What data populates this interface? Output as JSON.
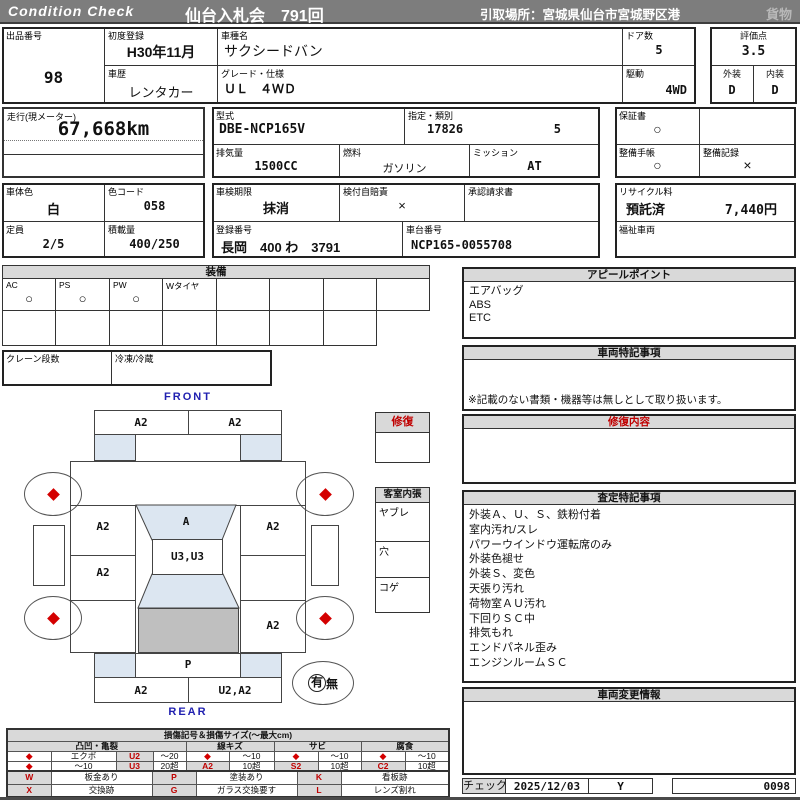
{
  "header": {
    "brand": "Condition  Check",
    "auction_title": "仙台入札会　791回",
    "pickup_location": "引取場所：宮城県仙台市宮城野区港",
    "category": "貨物"
  },
  "info": {
    "lot_label": "出品番号",
    "lot_no": "98",
    "first_reg_label": "初度登録",
    "first_reg": "H30年11月",
    "model_name_label": "車種名",
    "model_name": "サクシードバン",
    "history_label": "車歴",
    "history": "レンタカー",
    "grade_label": "グレード・仕様",
    "grade": "ＵＬ　４ＷＤ",
    "doors_label": "ドア数",
    "doors": "5",
    "drive_label": "駆動",
    "drive": "4WD",
    "score_label": "評価点",
    "score": "3.5",
    "exterior_label": "外装",
    "exterior_grade": "D",
    "interior_label": "内装",
    "interior_grade": "D"
  },
  "meter": {
    "label": "走行(現メーター)",
    "value": "67,668km"
  },
  "spec": {
    "model_code_label": "型式",
    "model_code": "DBE-NCP165V",
    "class_label": "指定・類別",
    "class_no": "17826",
    "class_sub": "5",
    "warranty_label": "保証書",
    "warranty": "○",
    "displacement_label": "排気量",
    "displacement": "1500CC",
    "fuel_label": "燃料",
    "fuel": "ガソリン",
    "mission_label": "ミッション",
    "mission": "AT",
    "maintenance_book_label": "整備手帳",
    "maintenance_book": "○",
    "maintenance_record_label": "整備記録",
    "maintenance_record": "×"
  },
  "registration": {
    "body_color_label": "車体色",
    "body_color": "白",
    "color_code_label": "色コード",
    "color_code": "058",
    "inspection_label": "車検期限",
    "inspection": "抹消",
    "insurance_label": "検付自賠責",
    "insurance": "×",
    "approval_label": "承認請求書",
    "recycle_label": "リサイクル料",
    "recycle_status": "預託済",
    "recycle_fee": "7,440円",
    "capacity_label": "定員",
    "capacity": "2/5",
    "load_label": "積載量",
    "load": "400/250",
    "reg_no_label": "登録番号",
    "reg_no": "長岡　400 わ　3791",
    "chassis_label": "車台番号",
    "chassis_no": "NCP165-0055708",
    "welfare_label": "福祉車両"
  },
  "equipment": {
    "title": "装備",
    "labels": [
      "AC",
      "PS",
      "PW",
      "Wタイヤ",
      "",
      "",
      "",
      ""
    ],
    "values": [
      "○",
      "○",
      "○",
      "",
      "",
      "",
      "",
      ""
    ],
    "crane_label": "クレーン段数",
    "fridge_label": "冷凍/冷蔵"
  },
  "diagram": {
    "front_label": "FRONT",
    "rear_label": "REAR",
    "front_bumper_left": "A2",
    "front_bumper_right": "A2",
    "windshield": "A",
    "left_front_panel": "A2",
    "left_rear_panel": "A2",
    "right_front_panel": "A2",
    "right_rear_panel": "A2",
    "roof": "U3,U3",
    "tailgate": "P",
    "rear_bumper_left": "A2",
    "rear_bumper_right": "U2,A2",
    "spare_yes": "有",
    "spare_no": "無"
  },
  "repair_box": {
    "title": "修復"
  },
  "cabin": {
    "title": "客室内張",
    "rows": [
      "ヤブレ",
      "穴",
      "コゲ"
    ]
  },
  "panels": {
    "appeal": {
      "title": "アピールポイント",
      "items": [
        "エアバッグ",
        "ABS",
        "ETC"
      ]
    },
    "vehicle_notes": {
      "title": "車両特記事項",
      "footnote": "※記載のない書類・機器等は無しとして取り扱います。"
    },
    "repair_detail": {
      "title": "修復内容"
    },
    "assessment": {
      "title": "査定特記事項",
      "items": [
        "外装Ａ、Ｕ、Ｓ、鉄粉付着",
        "室内汚れ/スレ",
        "パワーウインドウ運転席のみ",
        "外装色褪せ",
        "外装Ｓ、変色",
        "天張り汚れ",
        "荷物室ＡＵ汚れ",
        "下回りＳＣ中",
        "排気もれ",
        "エンドパネル歪み",
        "エンジンルームＳＣ"
      ]
    },
    "changes": {
      "title": "車両変更情報"
    }
  },
  "check": {
    "label": "チェック",
    "date": "2025/12/03",
    "inspector": "Y",
    "sheet_no": "0098"
  },
  "legend": {
    "title": "損傷記号＆損傷サイズ(〜最大cm)",
    "groups": [
      "凸凹・亀裂",
      "線キズ",
      "サビ",
      "腐食"
    ],
    "rows": [
      [
        "◆",
        "エクボ",
        "U2",
        "〜20",
        "◆",
        "〜10",
        "◆",
        "〜10",
        "◆",
        "〜10"
      ],
      [
        "◆",
        "〜10",
        "U3",
        "20超",
        "A2",
        "10超",
        "S2",
        "10超",
        "C2",
        "10超"
      ]
    ],
    "marks": [
      [
        "W",
        "板金あり",
        "P",
        "塗装あり",
        "K",
        "看板跡"
      ],
      [
        "X",
        "交換跡",
        "G",
        "ガラス交換要す",
        "L",
        "レンズ割れ"
      ]
    ]
  },
  "colors": {
    "accent_red": "#c00000",
    "header_gray": "#7d7d7d",
    "panel_gray": "#d9d9d9",
    "shade_blue": "#dce6f1",
    "gate_gray": "#bfbfbf",
    "label_blue": "#2020b0"
  }
}
